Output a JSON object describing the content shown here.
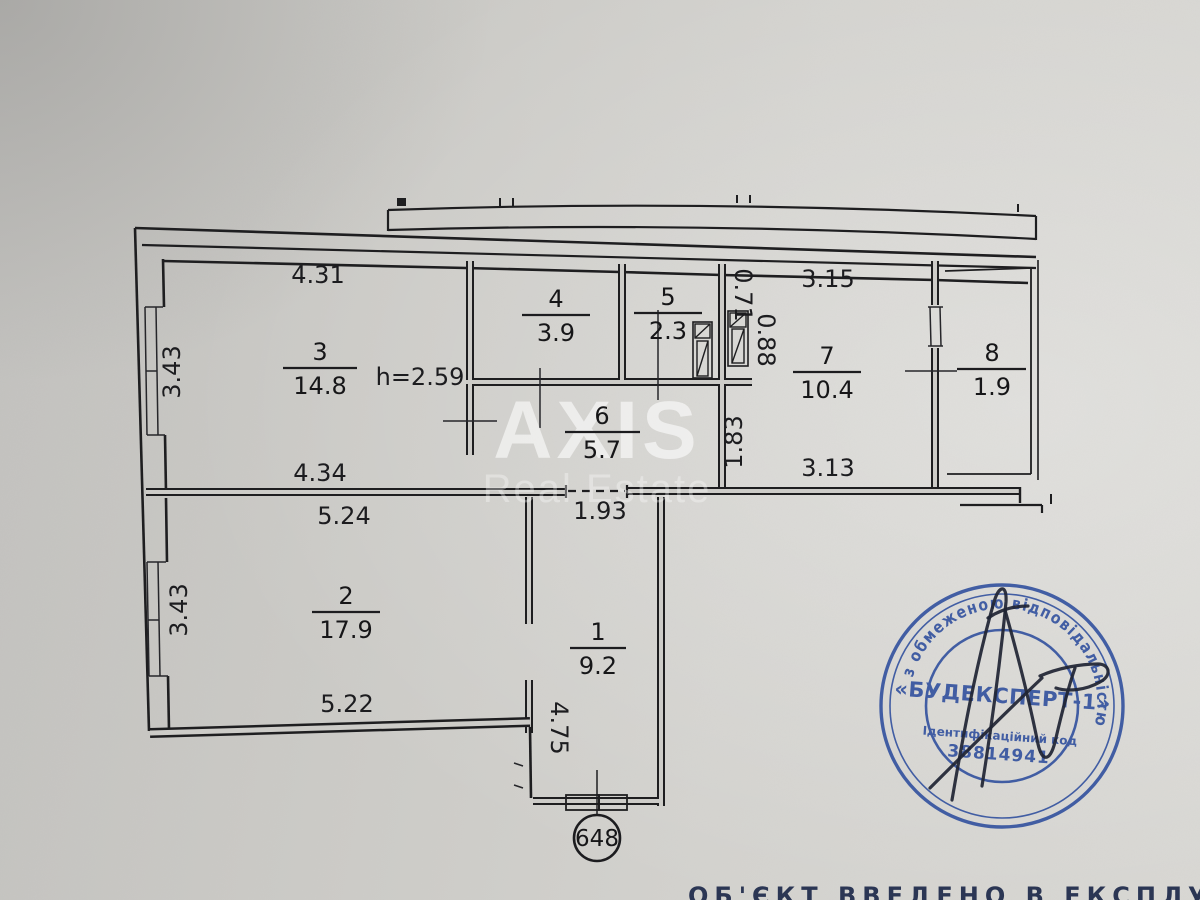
{
  "page": {
    "paper_color": "#cdccc8",
    "caption": "ОБ'ЄКТ ВВЕДЕНО В ЕКСПЛУАТАЦІЮ:"
  },
  "watermark": {
    "brand": "AXIS",
    "subtitle": "Real Estate"
  },
  "plan": {
    "unit_number": "648",
    "ceiling_height": "h=2.59",
    "rooms": [
      {
        "number": "1",
        "area": "9.2"
      },
      {
        "number": "2",
        "area": "17.9"
      },
      {
        "number": "3",
        "area": "14.8"
      },
      {
        "number": "4",
        "area": "3.9"
      },
      {
        "number": "5",
        "area": "2.3"
      },
      {
        "number": "6",
        "area": "5.7"
      },
      {
        "number": "7",
        "area": "10.4"
      },
      {
        "number": "8",
        "area": "1.9"
      }
    ],
    "dimensions": {
      "room3_width_top": "4.31",
      "room3_depth": "3.43",
      "room3_width_bottom": "4.34",
      "room2_width_top": "5.24",
      "room2_depth": "3.43",
      "room2_width_bottom": "5.22",
      "hall_opening": "1.93",
      "corridor_depth": "4.75",
      "room7_width_top": "3.15",
      "room7_width_bottom": "3.13",
      "room7_depth": "1.83",
      "shaft_small": "0.71",
      "shaft_large": "0.88"
    }
  },
  "stamp": {
    "ring_text": "м.Київ * Україна * Товариство з обмеженою відповідальністю",
    "company": "«БУДЕКСПЕРТ-1»",
    "id_label": "Ідентифікаційний код",
    "id_value": "38814941",
    "ink_color": "#2d4d9d"
  }
}
